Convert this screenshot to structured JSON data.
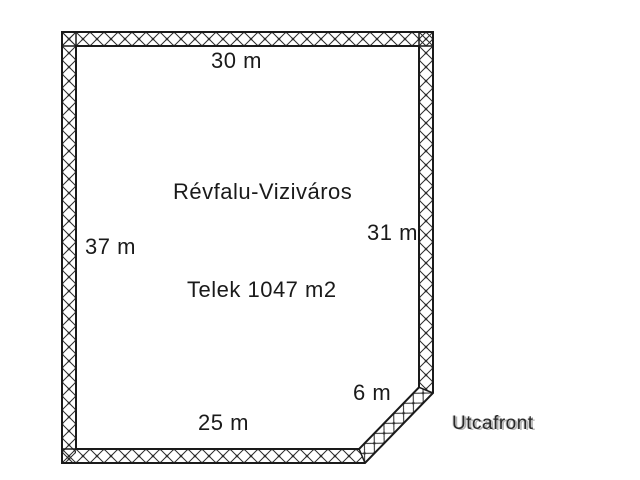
{
  "canvas": {
    "background": "#ffffff",
    "line_color": "#1a1a1a",
    "hatch_color": "#2b2b2b"
  },
  "parcel": {
    "district_label": "Révfalu-Viziváros",
    "area_label": "Telek 1047 m2",
    "street_front_label": "Utcafront",
    "dimensions": {
      "top": "30 m",
      "left": "37 m",
      "right": "31 m",
      "bottom": "25 m",
      "corner": "6 m"
    }
  }
}
